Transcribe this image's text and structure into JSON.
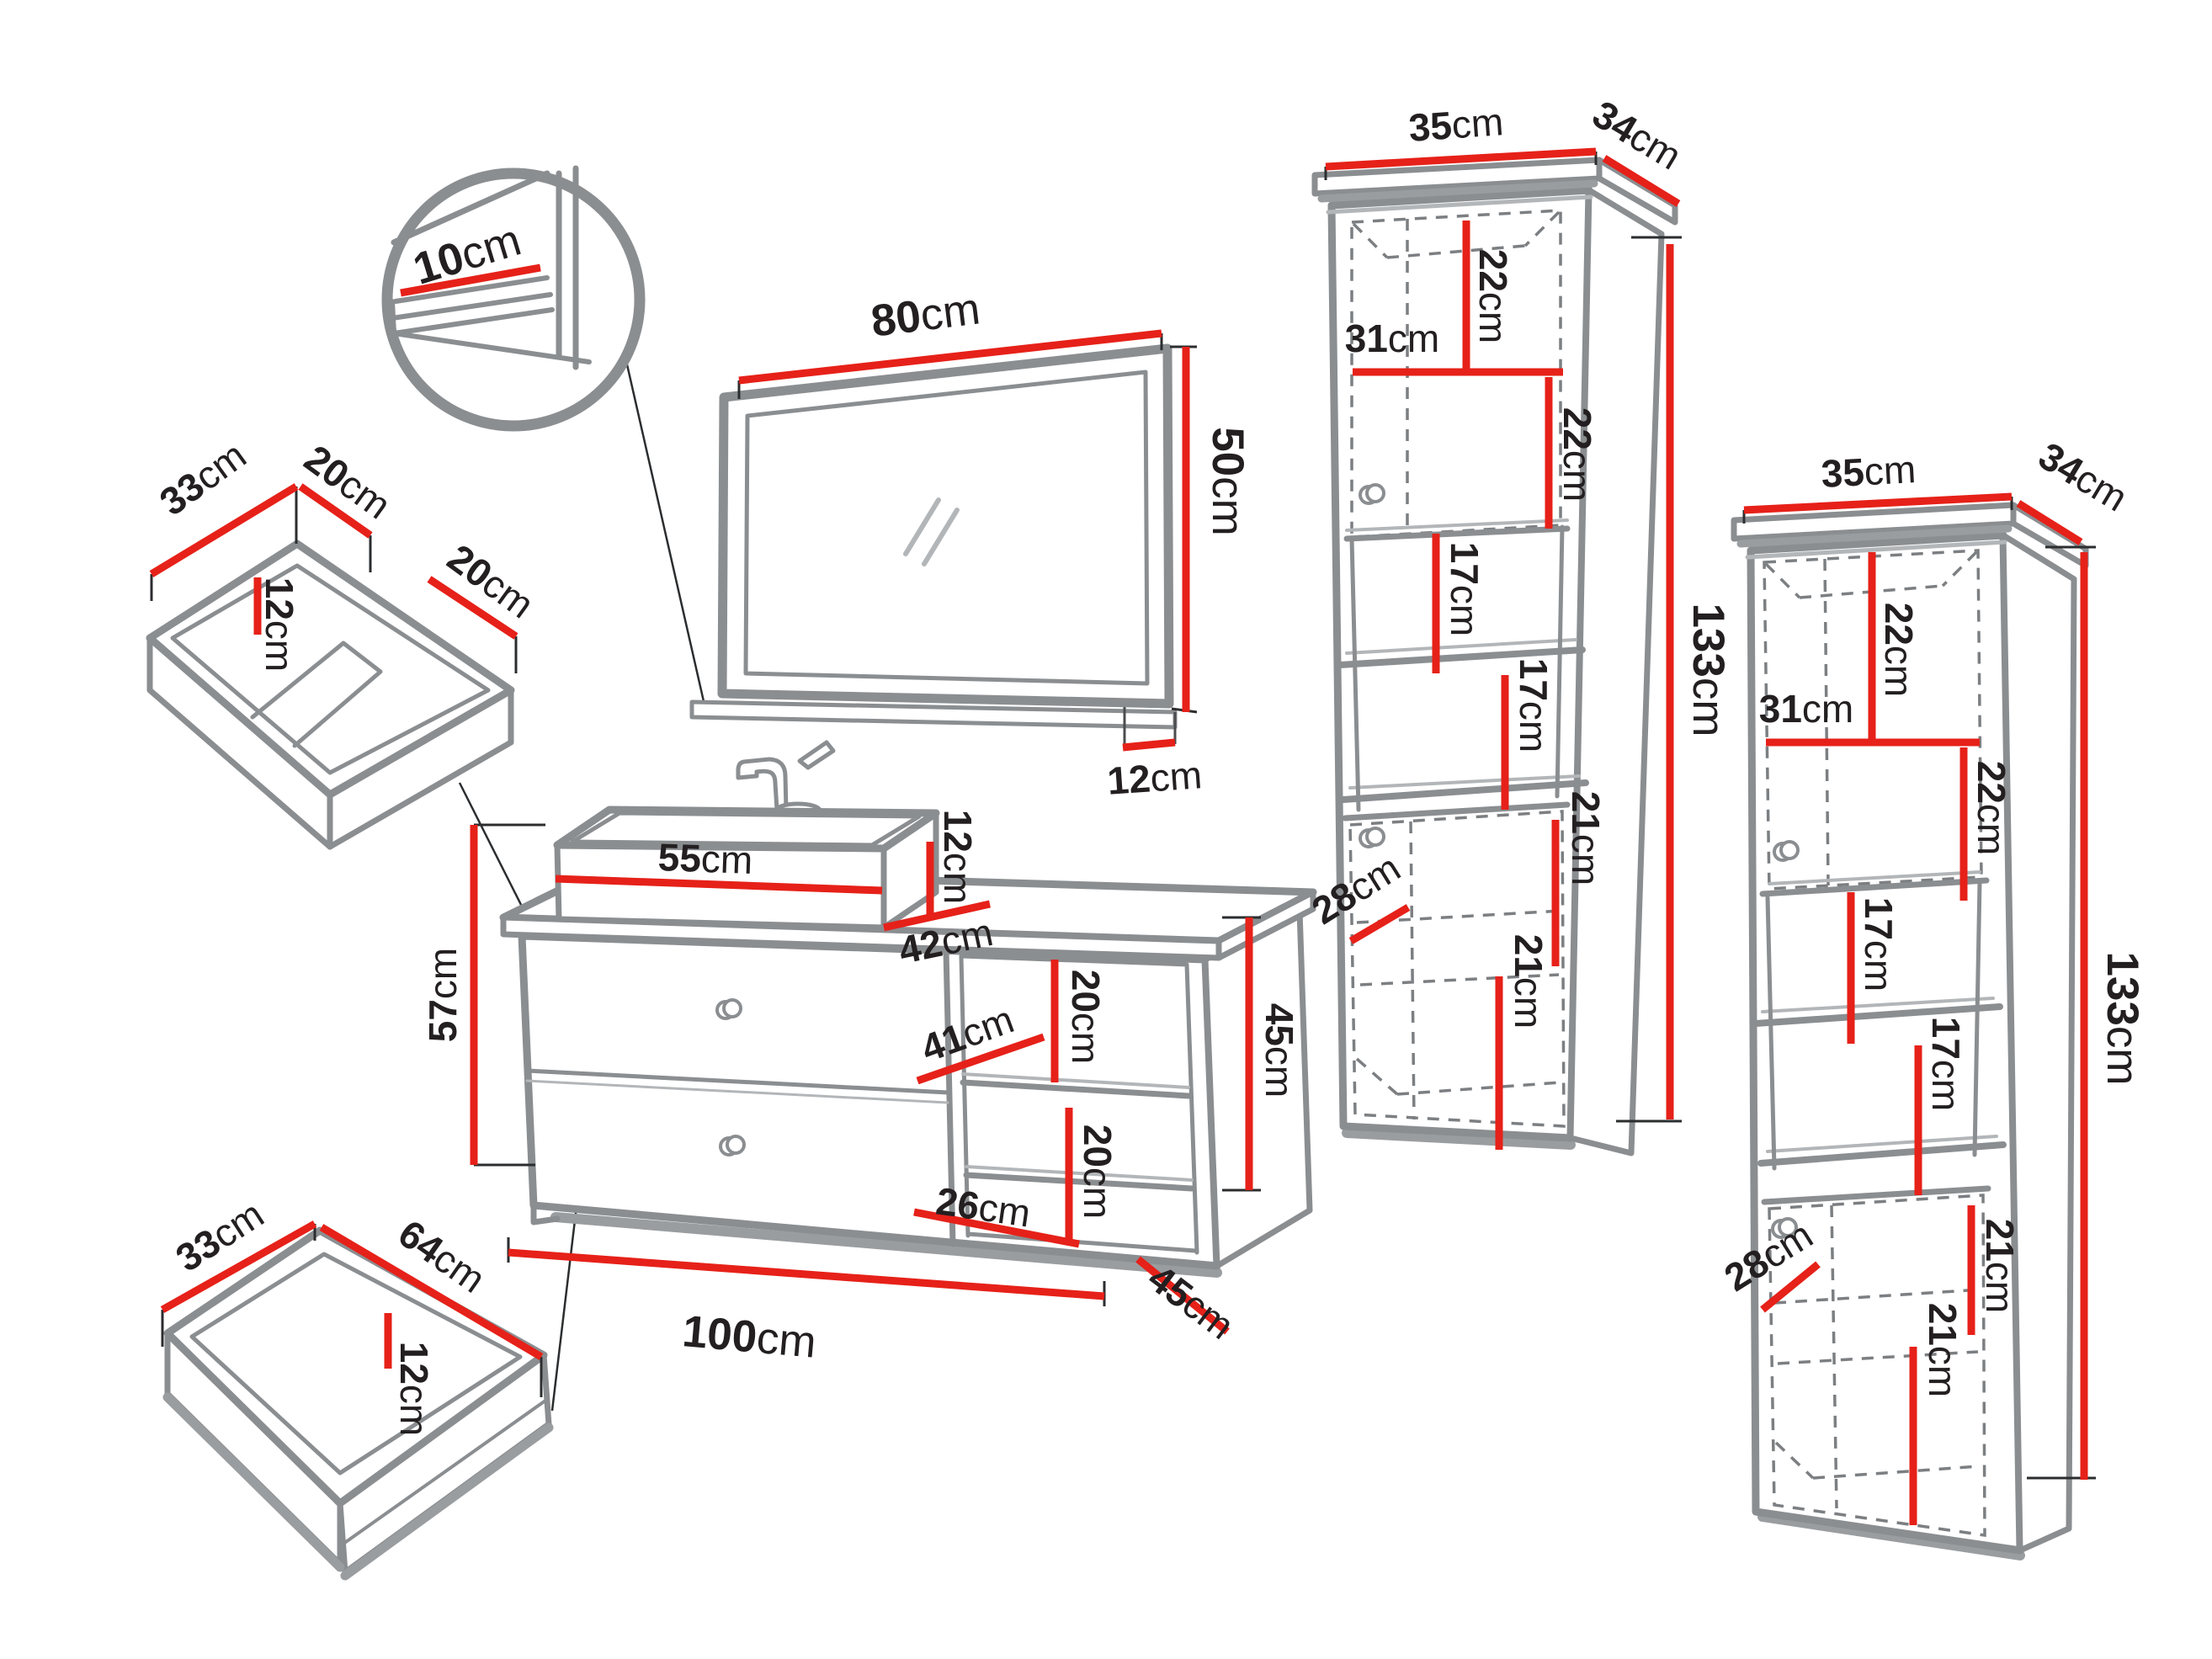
{
  "unit": "cm",
  "colors": {
    "dimension_red": "#e62119",
    "furniture_gray": "#8b8e91",
    "text_black": "#231f20",
    "background": "#ffffff"
  },
  "pieces": {
    "mirror": {
      "width_cm": 80,
      "height_cm": 50,
      "shelf_depth_cm": 12,
      "detail_shelf_width_cm": 10
    },
    "washbasin": {
      "width_cm": 55,
      "height_cm": 12,
      "depth_cm": 42
    },
    "vanity_cabinet": {
      "width_cm": 100,
      "left_height_cm": 57,
      "right_height_cm": 45,
      "depth_cm": 45,
      "open_shelf": {
        "width_cm": 41,
        "upper_height_cm": 20,
        "lower_height_cm": 20,
        "bottom_width_cm": 26
      }
    },
    "top_drawer_insert": {
      "depth_cm": 33,
      "left_width_cm": 20,
      "right_width_cm": 20,
      "height_cm": 12
    },
    "bottom_drawer_insert": {
      "depth_cm": 33,
      "width_cm": 64,
      "height_cm": 12
    },
    "tall_cabinet_left": {
      "width_cm": 35,
      "depth_cm": 34,
      "height_cm": 133,
      "inner_depth_cm": 28,
      "inner_top_width_cm": 31,
      "section_heights_cm": [
        22,
        22,
        17,
        17,
        21,
        21
      ]
    },
    "tall_cabinet_right": {
      "width_cm": 35,
      "depth_cm": 34,
      "height_cm": 133,
      "inner_depth_cm": 28,
      "inner_top_width_cm": 31,
      "section_heights_cm": [
        22,
        22,
        17,
        17,
        21,
        21
      ]
    }
  },
  "dims": {
    "detail_10": {
      "num": "10",
      "unit": "cm"
    },
    "mirror_80": {
      "num": "80",
      "unit": "cm"
    },
    "mirror_50": {
      "num": "50",
      "unit": "cm"
    },
    "mirror_12": {
      "num": "12",
      "unit": "cm"
    },
    "top_insert_33": {
      "num": "33",
      "unit": "cm"
    },
    "top_insert_20_left": {
      "num": "20",
      "unit": "cm"
    },
    "top_insert_12": {
      "num": "12",
      "unit": "cm"
    },
    "top_insert_20_right": {
      "num": "20",
      "unit": "cm"
    },
    "sink_55": {
      "num": "55",
      "unit": "cm"
    },
    "sink_12": {
      "num": "12",
      "unit": "cm"
    },
    "sink_42": {
      "num": "42",
      "unit": "cm"
    },
    "vanity_57": {
      "num": "57",
      "unit": "cm"
    },
    "vanity_20_top": {
      "num": "20",
      "unit": "cm"
    },
    "vanity_41": {
      "num": "41",
      "unit": "cm"
    },
    "vanity_20_bottom": {
      "num": "20",
      "unit": "cm"
    },
    "vanity_26": {
      "num": "26",
      "unit": "cm"
    },
    "vanity_45_height": {
      "num": "45",
      "unit": "cm"
    },
    "vanity_100": {
      "num": "100",
      "unit": "cm"
    },
    "vanity_45_depth": {
      "num": "45",
      "unit": "cm"
    },
    "drawer_33": {
      "num": "33",
      "unit": "cm"
    },
    "drawer_64": {
      "num": "64",
      "unit": "cm"
    },
    "drawer_12": {
      "num": "12",
      "unit": "cm"
    },
    "cab1_35": {
      "num": "35",
      "unit": "cm"
    },
    "cab1_34": {
      "num": "34",
      "unit": "cm"
    },
    "cab1_22_top": {
      "num": "22",
      "unit": "cm"
    },
    "cab1_31": {
      "num": "31",
      "unit": "cm"
    },
    "cab1_22_mid": {
      "num": "22",
      "unit": "cm"
    },
    "cab1_17_top": {
      "num": "17",
      "unit": "cm"
    },
    "cab1_17_bottom": {
      "num": "17",
      "unit": "cm"
    },
    "cab1_21_top": {
      "num": "21",
      "unit": "cm"
    },
    "cab1_28": {
      "num": "28",
      "unit": "cm"
    },
    "cab1_21_bottom": {
      "num": "21",
      "unit": "cm"
    },
    "cab1_133": {
      "num": "133",
      "unit": "cm"
    },
    "cab2_35": {
      "num": "35",
      "unit": "cm"
    },
    "cab2_34": {
      "num": "34",
      "unit": "cm"
    },
    "cab2_22_top": {
      "num": "22",
      "unit": "cm"
    },
    "cab2_31": {
      "num": "31",
      "unit": "cm"
    },
    "cab2_22_mid": {
      "num": "22",
      "unit": "cm"
    },
    "cab2_17_top": {
      "num": "17",
      "unit": "cm"
    },
    "cab2_17_bottom": {
      "num": "17",
      "unit": "cm"
    },
    "cab2_21_top": {
      "num": "21",
      "unit": "cm"
    },
    "cab2_28": {
      "num": "28",
      "unit": "cm"
    },
    "cab2_21_bottom": {
      "num": "21",
      "unit": "cm"
    },
    "cab2_133": {
      "num": "133",
      "unit": "cm"
    }
  }
}
